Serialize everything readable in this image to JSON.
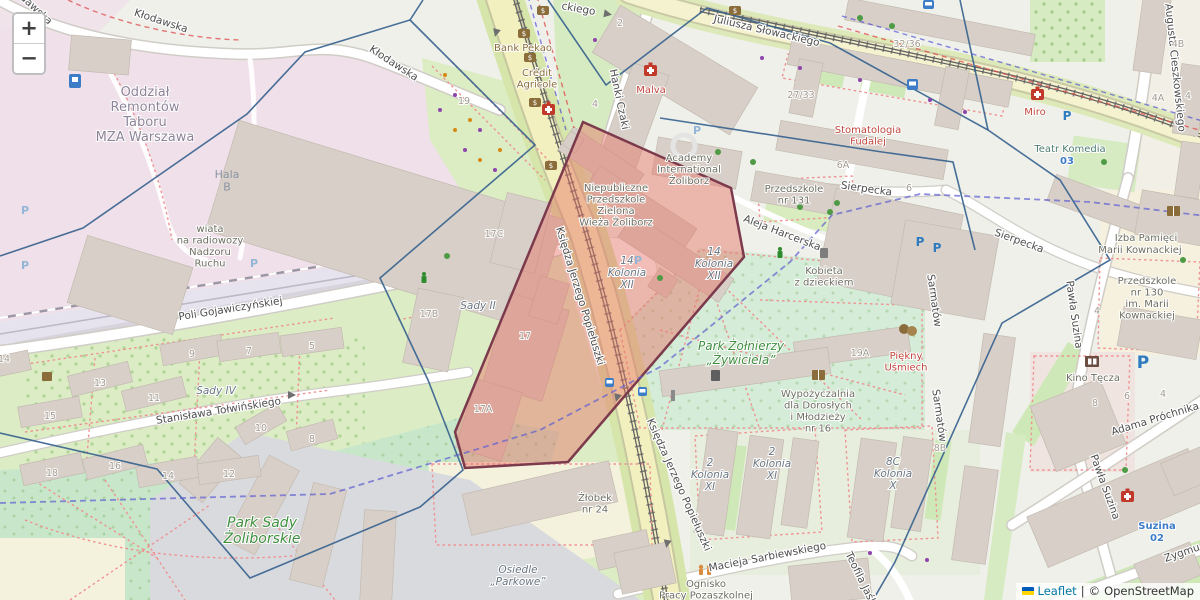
{
  "controls": {
    "zoom_in": "+",
    "zoom_out": "−"
  },
  "attribution": {
    "leaflet": "Leaflet",
    "divider": "|",
    "copyright": "©",
    "osm": "OpenStreetMap"
  },
  "icons": {
    "parking": "P"
  },
  "streets": {
    "klodawska": "Kłodawska",
    "slowackiego": "Juliusza Słowackiego",
    "slowackiego_part": "ckiego",
    "hanki": "Hanki Czaki",
    "cieszkowskiego": "Augusta Cieszkowskiego",
    "sierpecka": "Sierpecka",
    "harcerska": "Aleja Harcerska",
    "popieluszki": "Księdza Jerzego Popiełuszki",
    "gojawiczynskiej": "Poli Gojawiczyńskiej",
    "tolwinskiego": "Stanisława Tołwińskiego",
    "sarbiewskiego": "Macieja Sarbiewskiego",
    "teofila": "Teofila Jaśk",
    "prochnika": "Adama Próchnika",
    "suzina": "Pawła Suzina",
    "zygmunta": "Zygmu",
    "sarmatow": "Sarmatów"
  },
  "places": {
    "mza": "Oddział\nRemontów\nTaboru\nMZA Warszawa",
    "hala": "Hala\nB",
    "wiata": "wiata\nna radiowozy\nNadzoru\nRuchu",
    "bank": "Bank Pekao",
    "credit": "Crédit\nAgricole",
    "malva": "Malva",
    "academy": "Academy\nInternational\nŻoliborz",
    "zielona": "Niepubliczne\nPrzedszkole\nZielona\nWieża Żoliborz",
    "kolonia12": "14\nKolonia\nXII",
    "przedszkole131": "Przedszkole\nnr 131",
    "stomatologia": "Stomatologia\nFudalej",
    "miro": "Miro",
    "teatr": "Teatr Komedia",
    "stop03": "03",
    "izba1": "Izba Pamięci",
    "izba2": "Marii Kownackiej",
    "przedszkole130": "Przedszkole\nnr 130\nim. Marii\nKownackiej",
    "kobieta": "Kobieta\nz dzieckiem",
    "park_zolnierzy": "Park Żołnierzy\n„Żywiciela”",
    "wypozyczalnia": "Wypożyczalnia\ndla Dorosłych\ni Młodzieży\nnr 16",
    "piekny": "Piękny\nUśmiech",
    "kino": "Kino Tęcza",
    "suzina_name": "Suzina",
    "stop02": "02",
    "park_sady": "Park Sady\nŻoliborskie",
    "sady4": "Sady IV",
    "sady2": "Sady II",
    "zlobek": "Żłobek\nnr 24",
    "osiedle": "Osiedle\n„Parkowe”",
    "ognisko": "Ognisko\nPracy Pozaszkolnej",
    "kolonia11": "2\nKolonia\nXI",
    "kolonia10": "8C\nKolonia\nX"
  },
  "numbers": {
    "n27": "27/33",
    "n32": "32/36",
    "n4b": "4B",
    "n4a": "4A",
    "n4": "4",
    "n6a": "6A",
    "n6": "6",
    "n2": "2",
    "n19": "19",
    "n19a": "19A",
    "n17": "17",
    "n17a": "17A",
    "n17b": "17B",
    "n17c": "17C",
    "n8b": "8B",
    "n14": "14",
    "hanki4": "4",
    "suzina4": "4",
    "kino8": "8",
    "kino6": "6",
    "kino4": "4",
    "sady_top": [
      "15",
      "13",
      "11",
      "9",
      "7",
      "5"
    ],
    "sady_bot": [
      "18",
      "16",
      "14",
      "12",
      "10",
      "8"
    ]
  },
  "colors": {
    "highlight_fill": "rgba(230,113,99,0.45)",
    "highlight_stroke": "#7c3a4d",
    "boundary": "#35618e",
    "admin": "#5e5ed2",
    "poi_red": "#c0453c",
    "transit_blue": "#3d7dc8",
    "park_green": "#3f8f3f"
  }
}
